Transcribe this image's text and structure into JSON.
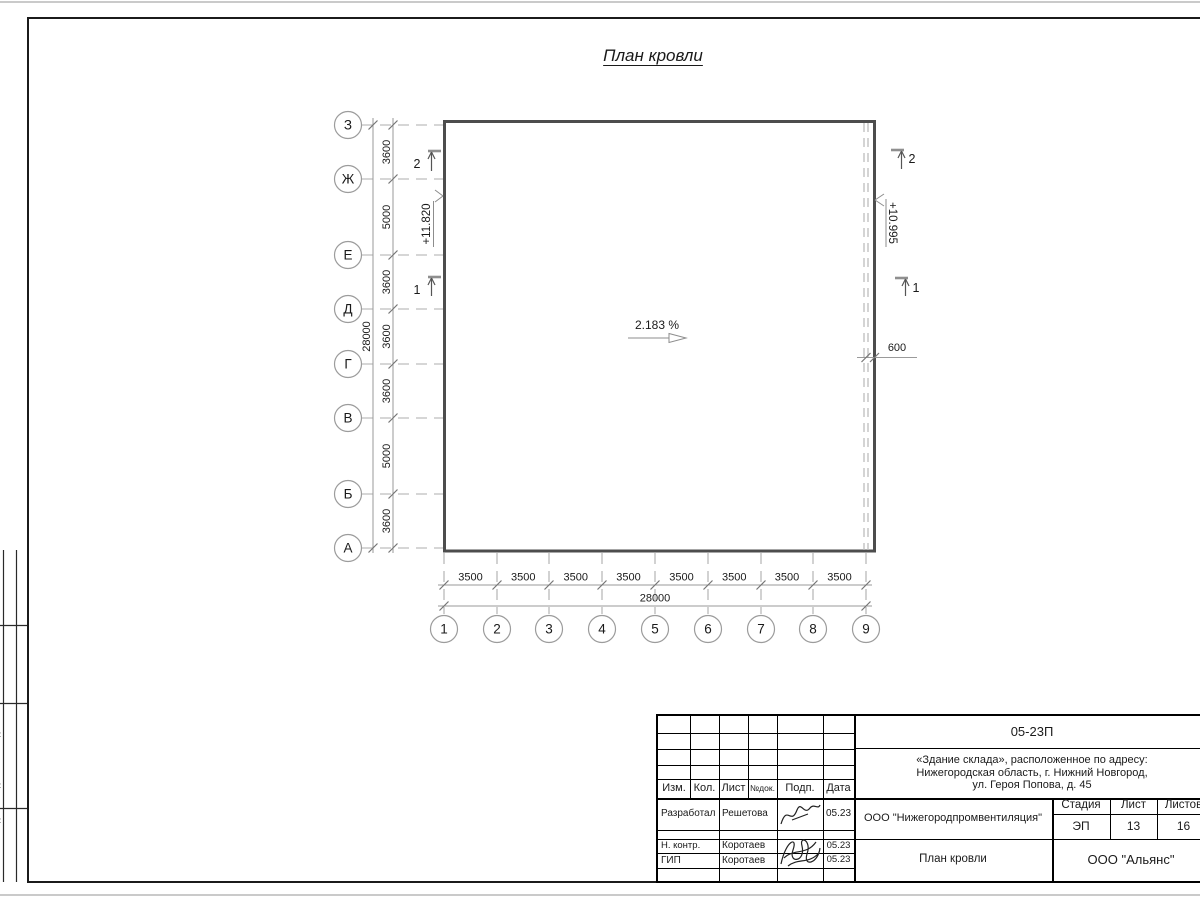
{
  "page": {
    "title": "План кровли"
  },
  "plan": {
    "slope_label": "2.183 %",
    "elevation_left": "+11.820",
    "elevation_right": "+10.995",
    "overhang_dim": "600",
    "row_axes": [
      "З",
      "Ж",
      "Е",
      "Д",
      "Г",
      "В",
      "Б",
      "А"
    ],
    "row_dims": [
      "3600",
      "5000",
      "3600",
      "3600",
      "3600",
      "5000",
      "3600"
    ],
    "row_total": "28000",
    "col_axes": [
      "1",
      "2",
      "3",
      "4",
      "5",
      "6",
      "7",
      "8",
      "9"
    ],
    "col_dims": [
      "3500",
      "3500",
      "3500",
      "3500",
      "3500",
      "3500",
      "3500",
      "3500"
    ],
    "col_total": "28000",
    "section_marks": {
      "left_top": "2",
      "left_bottom": "1",
      "right_top": "2",
      "right_bottom": "1"
    }
  },
  "title_block": {
    "doc_number": "05-23П",
    "project_lines": [
      "«Здание склада», расположенное по адресу:",
      "Нижегородская область, г. Нижний Новгород,",
      "ул. Героя Попова, д. 45"
    ],
    "header_cols": [
      "Изм.",
      "Кол.",
      "Лист",
      "№док.",
      "Подп.",
      "Дата"
    ],
    "sign_rows": [
      {
        "role": "Разработал",
        "name": "Решетова",
        "date": "05.23"
      },
      {
        "role": "Н. контр.",
        "name": "Коротаев",
        "date": "05.23"
      },
      {
        "role": "ГИП",
        "name": "Коротаев",
        "date": "05.23"
      }
    ],
    "org": "ООО \"Нижегородпромвентиляция\"",
    "drawing_title": "План кровли",
    "stage_label": "Стадия",
    "sheet_label": "Лист",
    "sheets_label": "Листов",
    "stage": "ЭП",
    "sheet": "13",
    "sheets": "16",
    "company": "ООО \"Альянс\""
  },
  "side_stamp": {
    "fragments": [
      ":",
      ":",
      ":"
    ]
  }
}
